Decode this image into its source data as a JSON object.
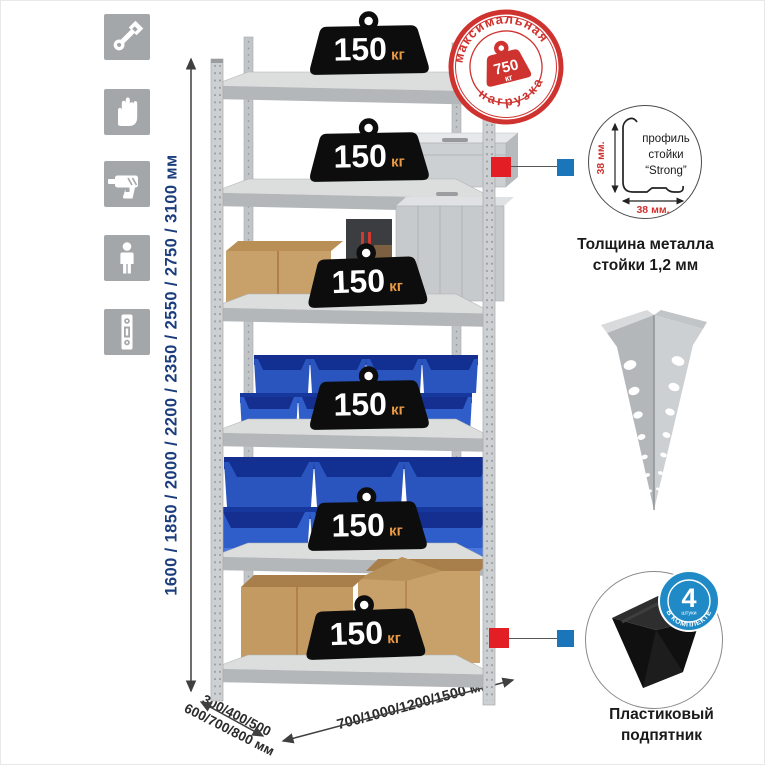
{
  "sidebar": {
    "items": [
      {
        "icon": "wrench-icon"
      },
      {
        "icon": "gloves-icon"
      },
      {
        "icon": "drill-icon"
      },
      {
        "icon": "person-icon"
      },
      {
        "icon": "level-icon"
      }
    ]
  },
  "height_dimension": {
    "label": "1600 / 1850 / 2000 / 2200 / 2350 / 2550 / 2750 / 3100 мм"
  },
  "depth_dimension": {
    "line1": "300/400/500",
    "line2": "600/700/800 мм"
  },
  "width_dimension": {
    "label": "700/1000/1200/1500 мм"
  },
  "shelf_badge": {
    "value": "150",
    "unit": "кг"
  },
  "max_load_stamp": {
    "arc_top": "максимальная",
    "arc_bottom": "нагрузка",
    "value": "750",
    "unit": "кг"
  },
  "profile_detail": {
    "label_line1": "профиль",
    "label_line2": "стойки",
    "label_line3": "“Strong”",
    "dim_vertical": "38 мм.",
    "dim_horizontal": "38 мм.",
    "caption_line1": "Толщина металла",
    "caption_line2": "стойки 1,2 мм"
  },
  "foot_detail": {
    "badge_value": "4",
    "badge_sub": "штуки",
    "badge_arc": "в комплекте",
    "caption_line1": "Пластиковый",
    "caption_line2": "подпятник"
  },
  "colors": {
    "stamp_red": "#cf332f",
    "callout_red": "#e31e24",
    "callout_blue": "#1b75bb",
    "qty_badge_blue": "#1f8ac6",
    "dimension_blue": "#1b3d7d",
    "bin_blue": "#2b59c3",
    "weight_unit_orange": "#e89a45"
  }
}
